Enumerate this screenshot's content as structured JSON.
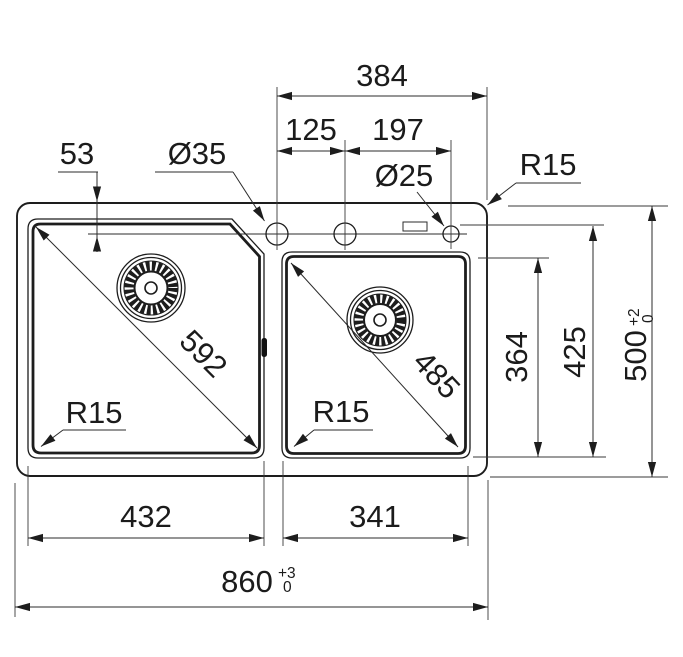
{
  "drawing": {
    "background": "#ffffff",
    "line_color": "#1d1d1d",
    "labels": {
      "deck_span": "384",
      "hole_pitch_left": "125",
      "hole_pitch_right": "197",
      "faucet_hole_diameter": "Ø35",
      "small_hole_diameter": "Ø25",
      "edge_to_hole_centerline": "53",
      "corner_radius_top_right": "R15",
      "corner_radius_left_bowl": "R15",
      "corner_radius_right_bowl": "R15",
      "left_bowl_diagonal": "592",
      "right_bowl_diagonal": "485",
      "right_bowl_depth": "364",
      "inner_depth": "425",
      "overall_depth": "500",
      "overall_depth_tolerance_upper": "+2",
      "overall_depth_tolerance_lower": "0",
      "left_bowl_width": "432",
      "right_bowl_width": "341",
      "overall_width": "860",
      "overall_width_tolerance_upper": "+3",
      "overall_width_tolerance_lower": "0"
    }
  }
}
